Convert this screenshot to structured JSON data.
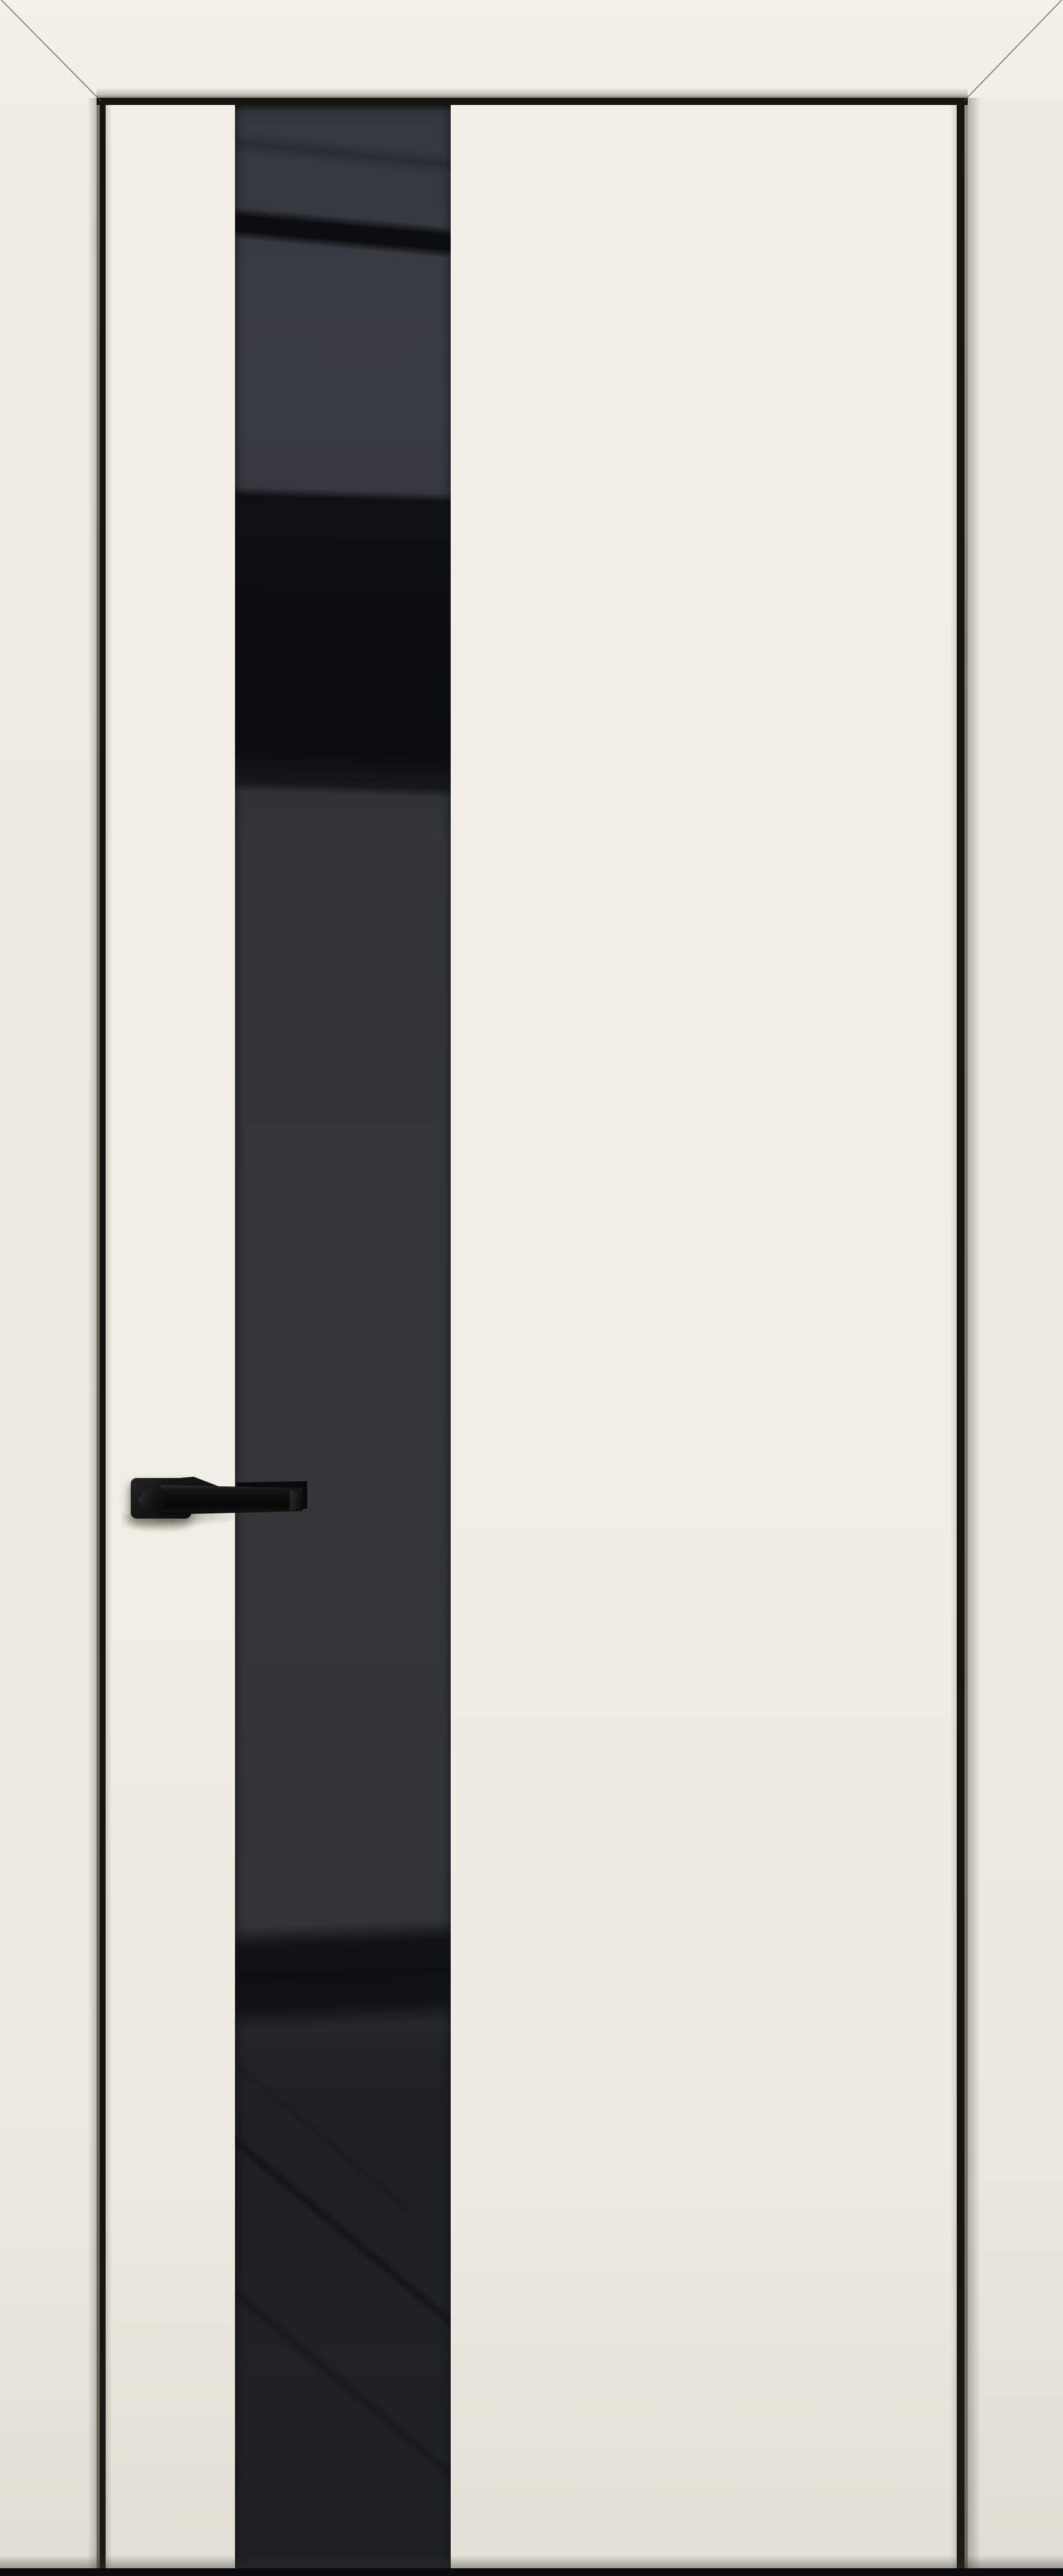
{
  "meta": {
    "description": "Product photo of a modern interior door: cream ivory leaf and casing with black aluminium edge trim, a full-height glossy black glass stripe insert, a black lever handle, mitered casing corners and a dark floor gap at the bottom",
    "scene_type": "door-product-photo",
    "parts": {
      "frame": "door casing with 45-degree mitered top corners",
      "leaf": "cream door leaf with black perimeter edge trim",
      "glass": "vertical glossy black glass insert with angled reflections",
      "handle": "matte black lever handle on square rosette",
      "floor_gap": "dark shadow gap under the door"
    }
  },
  "colors": {
    "casing_top": "#f4f1e8",
    "casing_left": "#f0ede4",
    "casing_right": "#eeebe2",
    "leaf_cream": "#f2efe6",
    "trim_black": "#15140f",
    "trim_edge_gray": "#6d695e",
    "glass_slate": "#343940",
    "glass_black_band": "#0b0d10",
    "glass_dark": "#0e1013",
    "glass_charcoal": "#333639",
    "glass_bottom": "#1e2124",
    "handle_black": "#141414",
    "bottom_bar": "#0a0b0c",
    "miter_line": "#55524a"
  }
}
